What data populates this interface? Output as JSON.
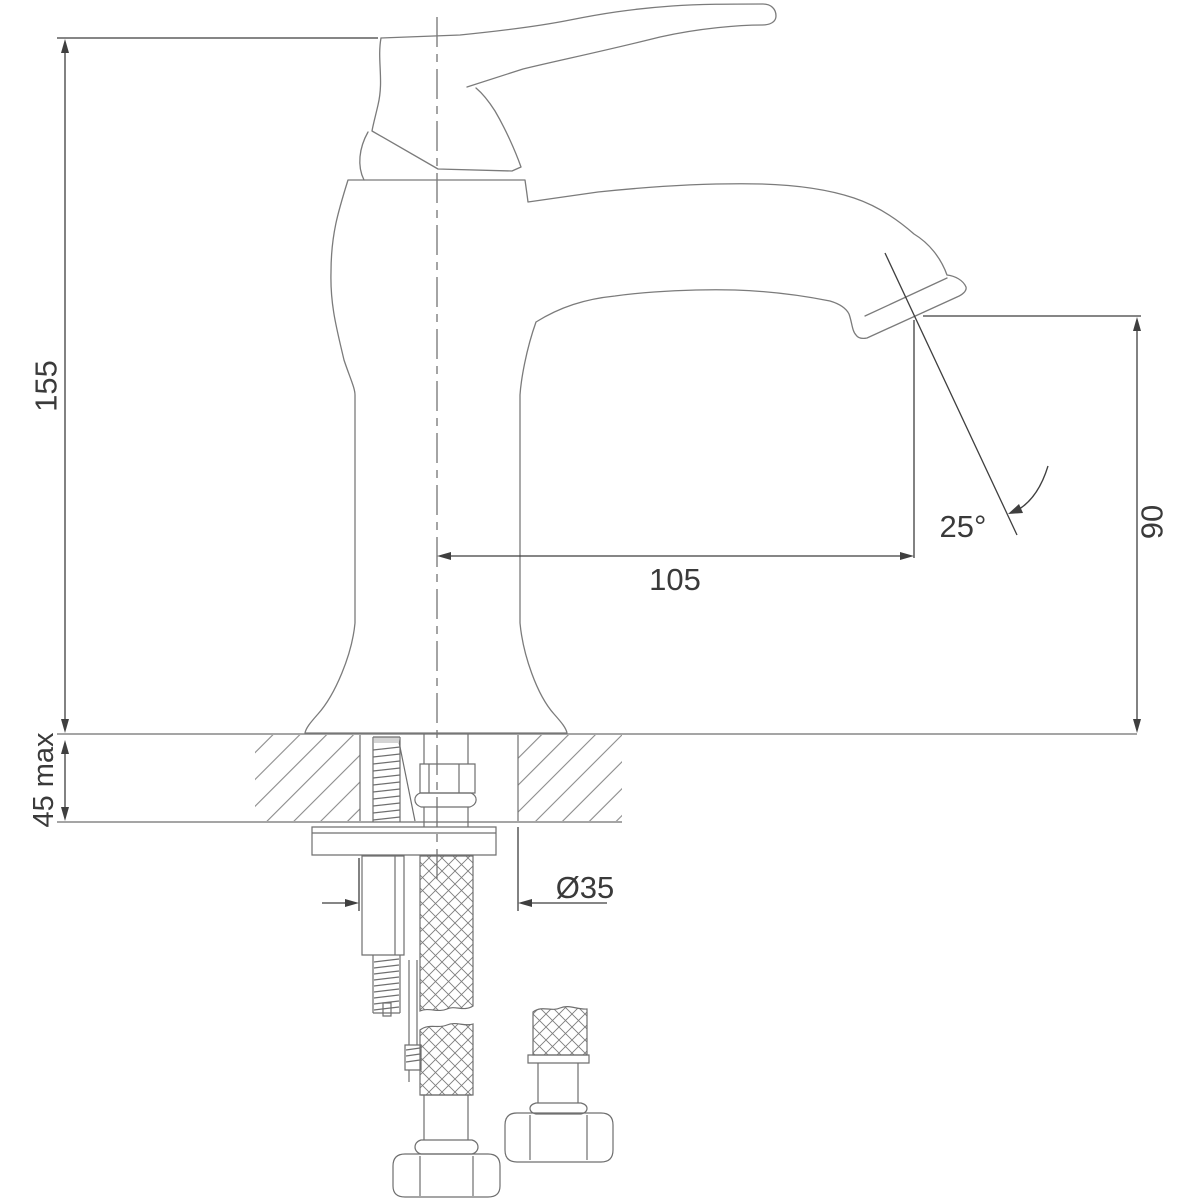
{
  "drawing": {
    "type": "technical-drawing",
    "subject": "Single-lever basin mixer tap - side elevation with mounting cross-section",
    "units": "mm",
    "dimensions": {
      "total_height": "155",
      "max_deck_thickness": "45 max",
      "spout_reach": "105",
      "stream_angle": "25°",
      "spout_height": "90",
      "mounting_hole_diameter": "Ø35"
    },
    "colors": {
      "background": "#ffffff",
      "outline": "#7b7b7b",
      "hardware": "#6f6f6f",
      "dimension": "#3f3f3f",
      "text": "#3a3a3a",
      "hatch": "#8a8a8a"
    }
  }
}
